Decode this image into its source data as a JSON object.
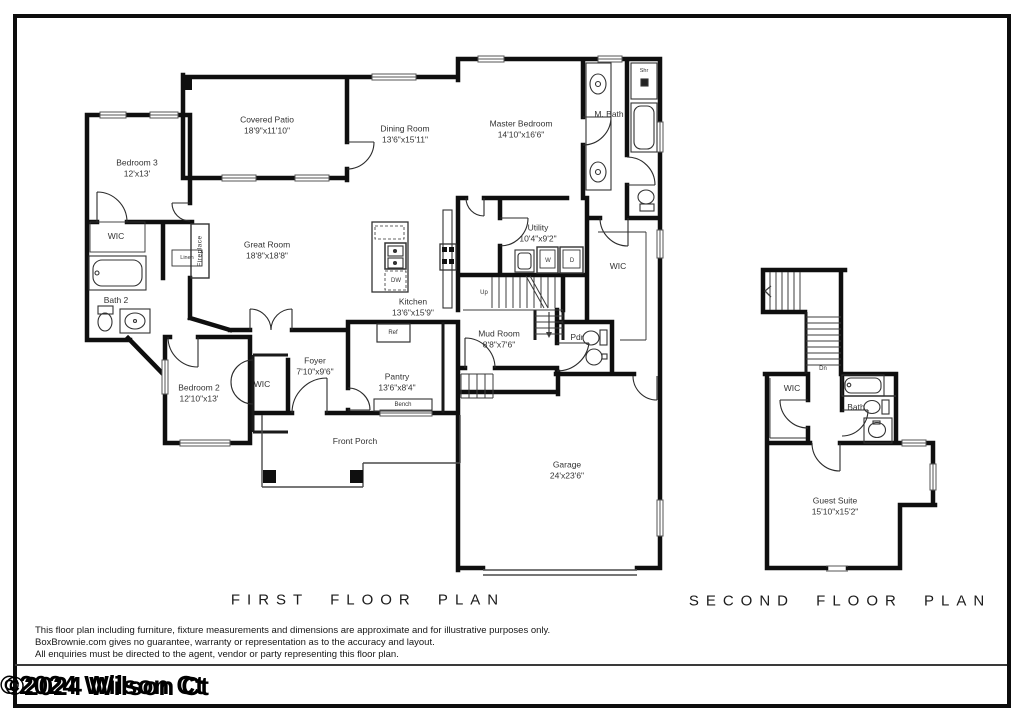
{
  "frame": {
    "watermark": "©2024 Wilson Ct"
  },
  "first_floor": {
    "title": "FIRST FLOOR PLAN",
    "rooms": [
      {
        "name": "Covered Patio",
        "dims": "18'9\"x11'10\""
      },
      {
        "name": "Dining Room",
        "dims": "13'6\"x15'11\""
      },
      {
        "name": "Master Bedroom",
        "dims": "14'10\"x16'6\""
      },
      {
        "name": "Bedroom 3",
        "dims": "12'x13'"
      },
      {
        "name": "Great Room",
        "dims": "18'8\"x18'8\""
      },
      {
        "name": "Kitchen",
        "dims": "13'6\"x15'9\""
      },
      {
        "name": "Utility",
        "dims": "10'4\"x9'2\""
      },
      {
        "name": "Mud Room",
        "dims": "8'8\"x7'6\""
      },
      {
        "name": "Bedroom 2",
        "dims": "12'10\"x13'"
      },
      {
        "name": "Foyer",
        "dims": "7'10\"x9'6\""
      },
      {
        "name": "Pantry",
        "dims": "13'6\"x8'4\""
      },
      {
        "name": "Garage",
        "dims": "24'x23'6\""
      }
    ],
    "labels": {
      "wic_bed3": "WIC",
      "m_bath": "M. Bath",
      "shr": "Shr",
      "bath2": "Bath 2",
      "wic_master": "WIC",
      "wic_bed2": "WIC",
      "pdr": "Pdr",
      "linen": "Linen",
      "fireplace": "Fireplace",
      "up": "Up",
      "ref": "Ref",
      "bench": "Bench",
      "dw": "DW",
      "w": "W",
      "d": "D",
      "front_porch": "Front Porch"
    }
  },
  "second_floor": {
    "title": "SECOND FLOOR PLAN",
    "rooms": [
      {
        "name": "Guest Suite",
        "dims": "15'10\"x15'2\""
      }
    ],
    "labels": {
      "wic": "WIC",
      "bath": "Bath",
      "dn": "Dn"
    }
  },
  "disclaimer": {
    "line1": "This floor plan including furniture, fixture measurements and dimensions are approximate and for illustrative purposes only.",
    "line2": "BoxBrownie.com gives no guarantee, warranty or representation as to the accuracy and layout.",
    "line3": "All enquiries must be directed to the agent, vendor or party representing this floor plan."
  },
  "colors": {
    "wall": "#0f0f0f",
    "line": "#3c3c3c",
    "text": "#333333"
  }
}
